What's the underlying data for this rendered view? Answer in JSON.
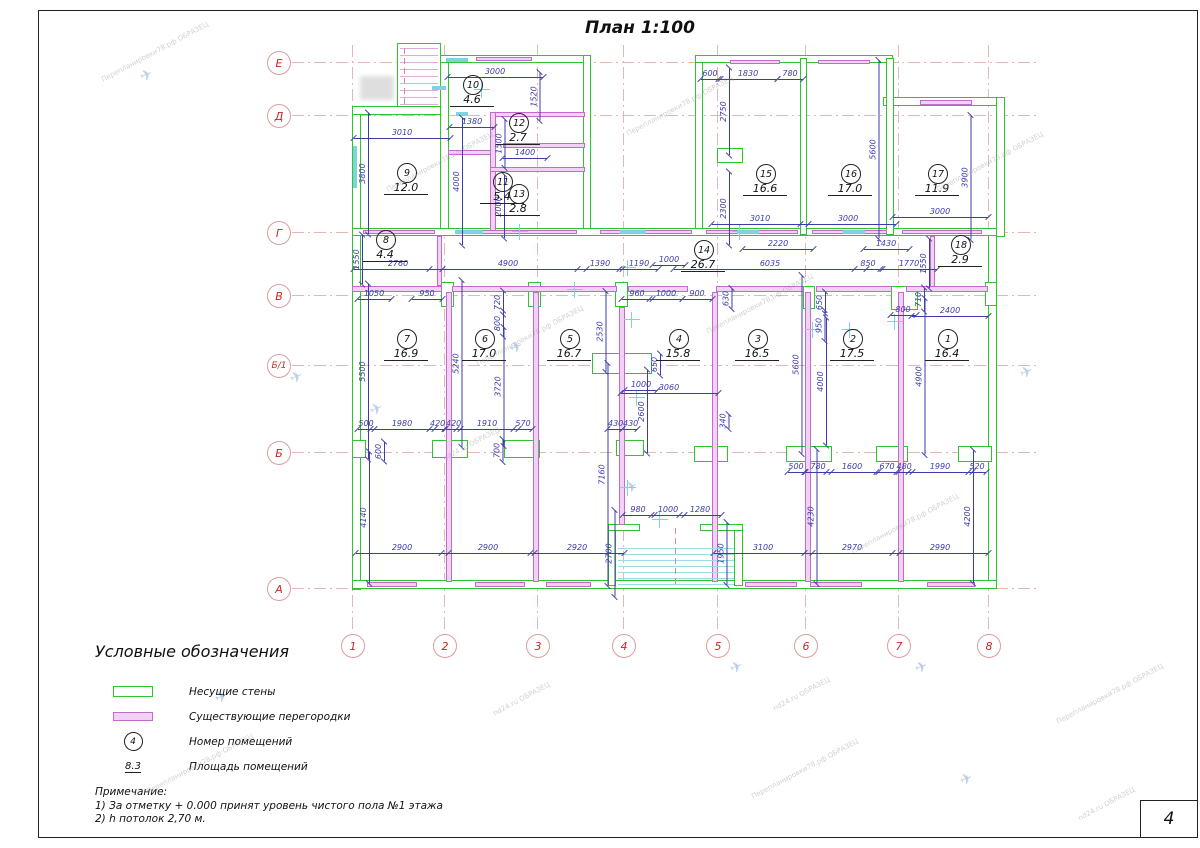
{
  "title": "План  1:100",
  "sheet": {
    "page_number": "4"
  },
  "colors": {
    "wall": "#2fc52f",
    "partition": "#c06cc8",
    "partition_fill": "#f2d2f4",
    "dimension": "#3c3caa",
    "axis_text": "#c62828",
    "axis_line": "#e5b6b6",
    "window": "#7ed3e2"
  },
  "axes": {
    "cols": [
      {
        "label": "1",
        "x": 352
      },
      {
        "label": "2",
        "x": 444
      },
      {
        "label": "3",
        "x": 537
      },
      {
        "label": "4",
        "x": 623
      },
      {
        "label": "5",
        "x": 717
      },
      {
        "label": "6",
        "x": 805
      },
      {
        "label": "7",
        "x": 898
      },
      {
        "label": "8",
        "x": 988
      }
    ],
    "rows": [
      {
        "label": "Е",
        "y": 62
      },
      {
        "label": "Д",
        "y": 115
      },
      {
        "label": "Г",
        "y": 232
      },
      {
        "label": "В",
        "y": 295
      },
      {
        "label": "Б/1",
        "y": 365
      },
      {
        "label": "Б",
        "y": 452
      },
      {
        "label": "А",
        "y": 588
      }
    ]
  },
  "plan": {
    "walls": [
      [
        352,
        106,
        9,
        484
      ],
      [
        352,
        106,
        96,
        9
      ],
      [
        440,
        55,
        9,
        180
      ],
      [
        428,
        55,
        162,
        8
      ],
      [
        583,
        55,
        8,
        180
      ],
      [
        695,
        55,
        8,
        180
      ],
      [
        695,
        55,
        198,
        8
      ],
      [
        883,
        97,
        122,
        9
      ],
      [
        996,
        97,
        9,
        140
      ],
      [
        988,
        228,
        9,
        361
      ],
      [
        352,
        228,
        645,
        8
      ],
      [
        352,
        580,
        645,
        9
      ],
      [
        800,
        58,
        7,
        177
      ],
      [
        886,
        58,
        8,
        177
      ],
      [
        592,
        353,
        60,
        21
      ],
      [
        608,
        524,
        8,
        62
      ],
      [
        734,
        524,
        9,
        62
      ],
      [
        608,
        524,
        32,
        7
      ],
      [
        700,
        524,
        43,
        7
      ],
      [
        397,
        43,
        44,
        64
      ],
      [
        717,
        148,
        26,
        15
      ],
      [
        352,
        440,
        14,
        18
      ],
      [
        432,
        440,
        36,
        18
      ],
      [
        504,
        440,
        36,
        18
      ],
      [
        616,
        440,
        28,
        16
      ],
      [
        694,
        446,
        34,
        16
      ],
      [
        786,
        446,
        46,
        16
      ],
      [
        876,
        446,
        32,
        16
      ],
      [
        958,
        446,
        34,
        16
      ],
      [
        441,
        282,
        13,
        25
      ],
      [
        528,
        282,
        13,
        25
      ],
      [
        615,
        282,
        13,
        25
      ],
      [
        803,
        286,
        12,
        23
      ],
      [
        891,
        286,
        27,
        24
      ],
      [
        985,
        282,
        12,
        24
      ]
    ],
    "partitions": [
      [
        448,
        150,
        45,
        5
      ],
      [
        490,
        112,
        95,
        5
      ],
      [
        490,
        112,
        6,
        120
      ],
      [
        503,
        143,
        82,
        5
      ],
      [
        490,
        167,
        95,
        5
      ],
      [
        437,
        236,
        5,
        50
      ],
      [
        930,
        236,
        5,
        52
      ],
      [
        352,
        286,
        90,
        6
      ],
      [
        452,
        286,
        165,
        6
      ],
      [
        628,
        286,
        60,
        6
      ],
      [
        716,
        286,
        88,
        6
      ],
      [
        816,
        286,
        76,
        6
      ],
      [
        906,
        286,
        82,
        6
      ],
      [
        446,
        292,
        6,
        290
      ],
      [
        533,
        292,
        6,
        290
      ],
      [
        619,
        307,
        6,
        218
      ],
      [
        712,
        292,
        6,
        290
      ],
      [
        805,
        292,
        6,
        290
      ],
      [
        898,
        292,
        6,
        290
      ],
      [
        476,
        57,
        56,
        4
      ],
      [
        730,
        60,
        50,
        4
      ],
      [
        818,
        60,
        52,
        4
      ],
      [
        920,
        100,
        52,
        5
      ],
      [
        363,
        230,
        72,
        4
      ],
      [
        462,
        230,
        115,
        4
      ],
      [
        600,
        230,
        92,
        4
      ],
      [
        706,
        230,
        92,
        4
      ],
      [
        812,
        230,
        75,
        4
      ],
      [
        902,
        230,
        80,
        4
      ],
      [
        367,
        582,
        50,
        5
      ],
      [
        475,
        582,
        50,
        5
      ],
      [
        546,
        582,
        45,
        5
      ],
      [
        745,
        582,
        52,
        5
      ],
      [
        810,
        582,
        52,
        5
      ],
      [
        927,
        582,
        48,
        5
      ]
    ],
    "windows": [
      [
        446,
        58,
        22,
        4
      ],
      [
        353,
        146,
        4,
        42
      ],
      [
        455,
        230,
        28,
        4
      ],
      [
        620,
        230,
        26,
        4
      ],
      [
        737,
        230,
        22,
        4
      ],
      [
        843,
        230,
        22,
        4
      ],
      [
        432,
        86,
        14,
        4
      ],
      [
        456,
        112,
        12,
        4
      ]
    ],
    "crosses": [
      [
        575,
        290
      ],
      [
        628,
        268
      ],
      [
        632,
        320
      ],
      [
        637,
        398
      ],
      [
        850,
        330
      ],
      [
        895,
        322
      ],
      [
        813,
        330
      ],
      [
        482,
        90
      ],
      [
        740,
        232
      ],
      [
        520,
        232
      ],
      [
        628,
        488
      ],
      [
        660,
        520
      ]
    ],
    "stairs": {
      "bottom": {
        "x": 618,
        "w": 116,
        "y1": 548,
        "y2": 588,
        "step": 6,
        "color": "#9fdbe4",
        "axis_x": 675,
        "axis_y": 528,
        "axis_h": 60
      },
      "top": {
        "x": 400,
        "w": 38,
        "y1": 48,
        "y2": 104,
        "step": 7,
        "color": "#d9aed9",
        "axis_x": 404,
        "axis_y": 48,
        "axis_h": 56
      }
    },
    "stamp": [
      360,
      76,
      34,
      24
    ],
    "rooms": [
      {
        "n": "1",
        "a": "16.4",
        "x": 947,
        "y": 338
      },
      {
        "n": "2",
        "a": "17.5",
        "x": 852,
        "y": 338
      },
      {
        "n": "3",
        "a": "16.5",
        "x": 757,
        "y": 338
      },
      {
        "n": "4",
        "a": "15.8",
        "x": 678,
        "y": 338
      },
      {
        "n": "5",
        "a": "16.7",
        "x": 569,
        "y": 338
      },
      {
        "n": "6",
        "a": "17.0",
        "x": 484,
        "y": 338
      },
      {
        "n": "7",
        "a": "16.9",
        "x": 406,
        "y": 338
      },
      {
        "n": "8",
        "a": "4.4",
        "x": 385,
        "y": 239
      },
      {
        "n": "9",
        "a": "12.0",
        "x": 406,
        "y": 172
      },
      {
        "n": "10",
        "a": "4.6",
        "x": 472,
        "y": 84
      },
      {
        "n": "11",
        "a": "5.4",
        "x": 502,
        "y": 181
      },
      {
        "n": "12",
        "a": "2.7",
        "x": 518,
        "y": 122
      },
      {
        "n": "13",
        "a": "2.8",
        "x": 518,
        "y": 193
      },
      {
        "n": "14",
        "a": "26.7",
        "x": 703,
        "y": 249
      },
      {
        "n": "15",
        "a": "16.6",
        "x": 765,
        "y": 173
      },
      {
        "n": "16",
        "a": "17.0",
        "x": 850,
        "y": 173
      },
      {
        "n": "17",
        "a": "11.9",
        "x": 937,
        "y": 173
      },
      {
        "n": "18",
        "a": "2.9",
        "x": 960,
        "y": 244
      }
    ],
    "dims": [
      [
        "3000",
        495,
        71,
        0
      ],
      [
        "1520",
        535,
        95,
        1
      ],
      [
        "1380",
        472,
        121,
        0
      ],
      [
        "3010",
        402,
        132,
        0
      ],
      [
        "3800",
        363,
        172,
        1
      ],
      [
        "4000",
        457,
        180,
        1
      ],
      [
        "1500",
        500,
        142,
        1
      ],
      [
        "1400",
        525,
        152,
        0
      ],
      [
        "2000",
        499,
        205,
        1
      ],
      [
        "600",
        710,
        73,
        0
      ],
      [
        "1830",
        748,
        73,
        0
      ],
      [
        "780",
        790,
        73,
        0
      ],
      [
        "2750",
        724,
        110,
        1
      ],
      [
        "2300",
        724,
        207,
        1
      ],
      [
        "3010",
        760,
        218,
        0
      ],
      [
        "3000",
        848,
        218,
        0
      ],
      [
        "3000",
        940,
        211,
        0
      ],
      [
        "5600",
        874,
        148,
        1
      ],
      [
        "3900",
        966,
        176,
        1
      ],
      [
        "2220",
        778,
        243,
        0
      ],
      [
        "1430",
        886,
        243,
        0
      ],
      [
        "1550",
        357,
        258,
        1
      ],
      [
        "2760",
        398,
        263,
        0
      ],
      [
        "4900",
        508,
        263,
        0
      ],
      [
        "1390",
        600,
        263,
        0
      ],
      [
        "1190",
        639,
        263,
        0
      ],
      [
        "1000",
        669,
        259,
        0
      ],
      [
        "6035",
        770,
        263,
        0
      ],
      [
        "850",
        868,
        263,
        0
      ],
      [
        "1770",
        909,
        263,
        0
      ],
      [
        "1550",
        924,
        262,
        1
      ],
      [
        "1050",
        374,
        293,
        0
      ],
      [
        "950",
        427,
        293,
        0
      ],
      [
        "960",
        637,
        293,
        0
      ],
      [
        "1000",
        666,
        293,
        0
      ],
      [
        "900",
        697,
        293,
        0
      ],
      [
        "720",
        498,
        301,
        1
      ],
      [
        "800",
        498,
        322,
        1
      ],
      [
        "630",
        727,
        297,
        1
      ],
      [
        "650",
        820,
        301,
        1
      ],
      [
        "950",
        820,
        324,
        1
      ],
      [
        "800",
        903,
        309,
        0
      ],
      [
        "710",
        919,
        298,
        1
      ],
      [
        "2400",
        950,
        310,
        0
      ],
      [
        "2530",
        601,
        330,
        1
      ],
      [
        "5500",
        363,
        370,
        1
      ],
      [
        "5240",
        457,
        362,
        1
      ],
      [
        "3720",
        499,
        385,
        1
      ],
      [
        "650",
        655,
        363,
        1
      ],
      [
        "1000",
        641,
        384,
        0
      ],
      [
        "3060",
        669,
        387,
        0
      ],
      [
        "2600",
        642,
        410,
        1
      ],
      [
        "5600",
        797,
        363,
        1
      ],
      [
        "4000",
        821,
        380,
        1
      ],
      [
        "4900",
        920,
        375,
        1
      ],
      [
        "340",
        724,
        420,
        1
      ],
      [
        "500",
        366,
        423,
        0
      ],
      [
        "1980",
        402,
        423,
        0
      ],
      [
        "420",
        437,
        423,
        0
      ],
      [
        "420",
        453,
        423,
        0
      ],
      [
        "1910",
        487,
        423,
        0
      ],
      [
        "570",
        523,
        423,
        0
      ],
      [
        "430",
        615,
        423,
        0
      ],
      [
        "430",
        630,
        423,
        0
      ],
      [
        "600",
        379,
        450,
        1
      ],
      [
        "700",
        498,
        449,
        1
      ],
      [
        "500",
        796,
        466,
        0
      ],
      [
        "780",
        818,
        466,
        0
      ],
      [
        "1600",
        852,
        466,
        0
      ],
      [
        "670",
        887,
        466,
        0
      ],
      [
        "480",
        904,
        466,
        0
      ],
      [
        "1990",
        940,
        466,
        0
      ],
      [
        "520",
        977,
        466,
        0
      ],
      [
        "4140",
        364,
        516,
        1
      ],
      [
        "7160",
        603,
        473,
        1
      ],
      [
        "2700",
        610,
        552,
        1
      ],
      [
        "1950",
        722,
        552,
        1
      ],
      [
        "980",
        638,
        509,
        0
      ],
      [
        "1000",
        668,
        509,
        0
      ],
      [
        "1280",
        700,
        509,
        0
      ],
      [
        "2900",
        402,
        547,
        0
      ],
      [
        "2900",
        488,
        547,
        0
      ],
      [
        "2920",
        577,
        547,
        0
      ],
      [
        "3100",
        763,
        547,
        0
      ],
      [
        "2970",
        852,
        547,
        0
      ],
      [
        "2990",
        940,
        547,
        0
      ],
      [
        "4230",
        812,
        515,
        1
      ],
      [
        "4200",
        968,
        515,
        1
      ]
    ]
  },
  "legend": {
    "title": "Условные  обозначения",
    "items": [
      {
        "type": "load-bearing-wall",
        "label": "Несущие  стены"
      },
      {
        "type": "existing-partition",
        "label": "Существующие  перегородки"
      },
      {
        "type": "room-number",
        "symbol": "4",
        "label": "Номер  помещений"
      },
      {
        "type": "room-area",
        "symbol": "8.3",
        "label": "Площадь  помещений"
      }
    ]
  },
  "notes": {
    "title": "Примечание:",
    "lines": [
      "1)  За  отметку  +  0.000  принят  уровень  чистого  пола  №1  этажа",
      "2)  h потолок  2,70 м."
    ]
  },
  "watermarks": [
    {
      "t": "Перепланировки78.рф ОБРАЗЕЦ",
      "x": 95,
      "y": 48
    },
    {
      "t": "Перепланировки78.рф ОБРАЗЕЦ",
      "x": 380,
      "y": 158
    },
    {
      "t": "Перепланировки78.рф ОБРАЗЕЦ",
      "x": 470,
      "y": 332
    },
    {
      "t": "Перепланировки78.рф ОБРАЗЕЦ",
      "x": 700,
      "y": 300
    },
    {
      "t": "Перепланировки78.рф ОБРАЗЕЦ",
      "x": 930,
      "y": 158
    },
    {
      "t": "Перепланировки78.рф ОБРАЗЕЦ",
      "x": 1050,
      "y": 690
    },
    {
      "t": "Перепланировки78.рф ОБРАЗЕЦ",
      "x": 745,
      "y": 765
    },
    {
      "t": "Перепланировки78.рф ОБРАЗЕЦ",
      "x": 140,
      "y": 760
    },
    {
      "t": "Перепланировки78.рф ОБРАЗЕЦ",
      "x": 845,
      "y": 520
    },
    {
      "t": "Перепланировки78.рф ОБРАЗЕЦ",
      "x": 620,
      "y": 102
    },
    {
      "t": "nd24.ru ОБРАЗЕЦ",
      "x": 440,
      "y": 440
    },
    {
      "t": "nd24.ru ОБРАЗЕЦ",
      "x": 490,
      "y": 695
    },
    {
      "t": "nd24.ru ОБРАЗЕЦ",
      "x": 770,
      "y": 690
    },
    {
      "t": "nd24.ru ОБРАЗЕЦ",
      "x": 1075,
      "y": 800
    }
  ],
  "birds": [
    {
      "x": 140,
      "y": 66
    },
    {
      "x": 290,
      "y": 368
    },
    {
      "x": 370,
      "y": 400
    },
    {
      "x": 510,
      "y": 338
    },
    {
      "x": 625,
      "y": 478
    },
    {
      "x": 730,
      "y": 658
    },
    {
      "x": 915,
      "y": 658
    },
    {
      "x": 215,
      "y": 688
    },
    {
      "x": 1020,
      "y": 363
    },
    {
      "x": 960,
      "y": 770
    }
  ]
}
